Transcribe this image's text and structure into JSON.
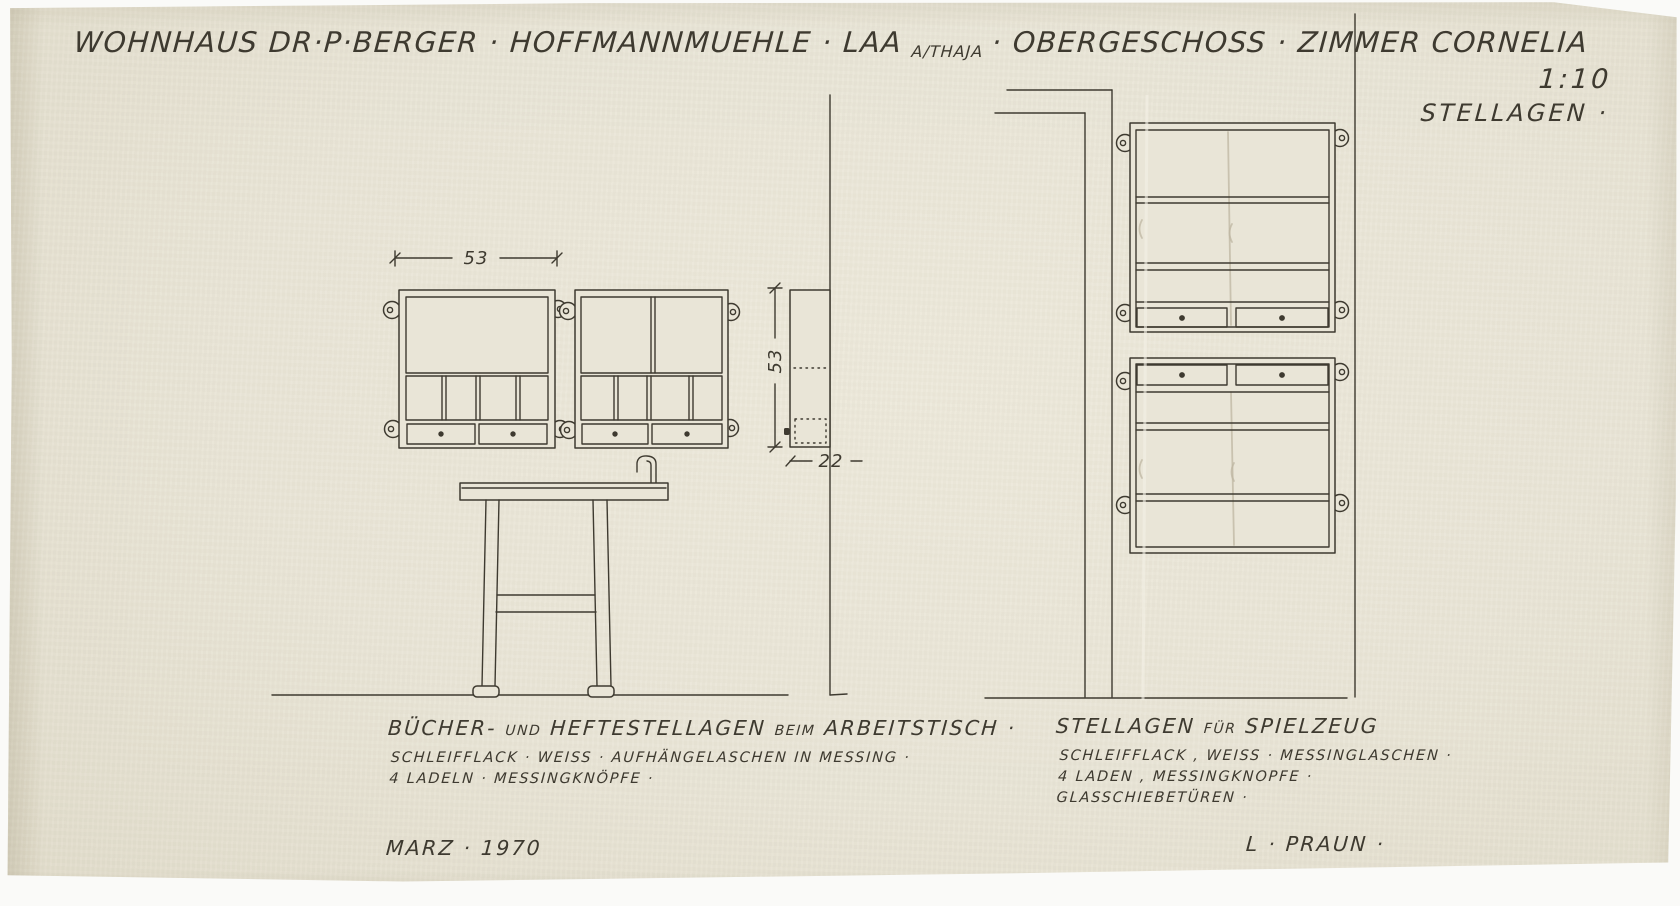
{
  "title": {
    "part1": "WOHNHAUS  DR·P·BERGER · HOFFMANNMUEHLE · LAA",
    "part_small": "A/THAJA",
    "part2": "· OBERGESCHOSS · ZIMMER  CORNELIA",
    "scale": "1:10",
    "subject": "STELLAGEN ·"
  },
  "dimensions": {
    "shelf_width_cm": "53",
    "shelf_height_cm": "53",
    "shelf_depth_cm": "22"
  },
  "left_drawing": {
    "caption_word1": "BÜCHER-",
    "caption_word2": "UND",
    "caption_word3": "HEFTESTELLAGEN",
    "caption_word4": "BEIM",
    "caption_word5": "ARBEITSTISCH ·",
    "spec_line1": "SCHLEIFFLACK · WEISS ·   AUFHÄNGELASCHEN   IN   MESSING ·",
    "spec_line2": "4 LADELN ·  MESSINGKNÖPFE ·",
    "date": "MARZ · 1970"
  },
  "right_drawing": {
    "caption_word1": "STELLAGEN",
    "caption_word2": "FÜR",
    "caption_word3": "SPIELZEUG",
    "spec_line1": "SCHLEIFFLACK , WEISS · MESSINGLASCHEN ·",
    "spec_line2": "4 LADEN ,  MESSINGKNOPFE ·",
    "spec_line3": "GLASSCHIEBETÜREN ·",
    "signature": "L · PRAUN ·"
  },
  "colors": {
    "paper": "#e9e5d7",
    "ink": "#3e3a30",
    "pencil": "#beb6a1"
  }
}
